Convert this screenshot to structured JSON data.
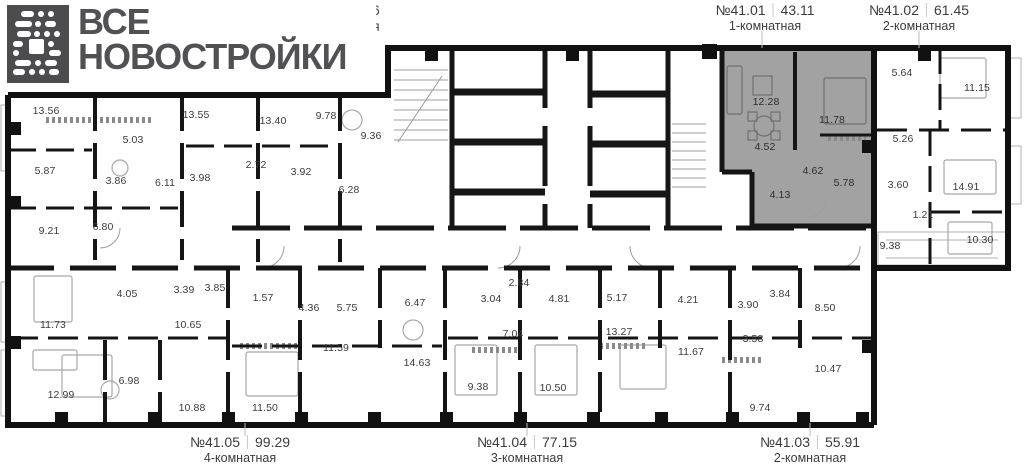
{
  "logo": {
    "line1": "ВСЕ",
    "line2": "НОВОСТРОЙКИ",
    "icon": "pixel-b-logo-icon"
  },
  "top_partial_text": {
    "line1": "46",
    "line2": "ия"
  },
  "colors": {
    "highlight_fill": "#a2a2a2",
    "wall": "#111111",
    "label_text": "#3b3b3b",
    "logo_background": "#4c4c4e",
    "logo_text": "#515154",
    "thin_line": "#9c9c9c",
    "leader_line": "#bbbbbb"
  },
  "apartment_labels": {
    "top": [
      {
        "number": "№41.01",
        "area": "43.11",
        "type": "1-комнатная",
        "x": 765,
        "highlighted": true
      },
      {
        "number": "№41.02",
        "area": "61.45",
        "type": "2-комнатная",
        "x": 919,
        "highlighted": false
      }
    ],
    "bottom": [
      {
        "number": "№41.05",
        "area": "99.29",
        "type": "4-комнатная",
        "x": 240,
        "highlighted": false
      },
      {
        "number": "№41.04",
        "area": "77.15",
        "type": "3-комнатная",
        "x": 527,
        "highlighted": false
      },
      {
        "number": "№41.03",
        "area": "55.91",
        "type": "2-комнатная",
        "x": 810,
        "highlighted": false
      }
    ]
  },
  "highlighted_apartment": {
    "number": "№41.01",
    "total_area": "43.11",
    "type": "1-комнатная",
    "room_areas": [
      "12.28",
      "11.78",
      "4.52",
      "4.62",
      "5.78",
      "4.13"
    ]
  },
  "rooms": [
    {
      "label": "13.56",
      "x": 46,
      "y": 111,
      "hl": false
    },
    {
      "label": "5.03",
      "x": 133,
      "y": 140,
      "hl": false
    },
    {
      "label": "13.55",
      "x": 196,
      "y": 115,
      "hl": false
    },
    {
      "label": "13.40",
      "x": 273,
      "y": 121,
      "hl": false
    },
    {
      "label": "9.78",
      "x": 326,
      "y": 116,
      "hl": false
    },
    {
      "label": "9.36",
      "x": 371,
      "y": 136,
      "hl": false
    },
    {
      "label": "5.87",
      "x": 45,
      "y": 171,
      "hl": false
    },
    {
      "label": "3.86",
      "x": 116,
      "y": 181,
      "hl": false
    },
    {
      "label": "6.11",
      "x": 165,
      "y": 183,
      "hl": false
    },
    {
      "label": "3.98",
      "x": 200,
      "y": 178,
      "hl": false
    },
    {
      "label": "2.72",
      "x": 256,
      "y": 165,
      "hl": false
    },
    {
      "label": "3.92",
      "x": 301,
      "y": 172,
      "hl": false
    },
    {
      "label": "6.28",
      "x": 349,
      "y": 190,
      "hl": false
    },
    {
      "label": "9.21",
      "x": 49,
      "y": 231,
      "hl": false
    },
    {
      "label": "6.80",
      "x": 103,
      "y": 227,
      "hl": false
    },
    {
      "label": "4.05",
      "x": 127,
      "y": 294,
      "hl": false
    },
    {
      "label": "3.39",
      "x": 184,
      "y": 290,
      "hl": false
    },
    {
      "label": "3.85",
      "x": 215,
      "y": 288,
      "hl": false
    },
    {
      "label": "11.73",
      "x": 53,
      "y": 325,
      "hl": false
    },
    {
      "label": "10.65",
      "x": 188,
      "y": 325,
      "hl": false
    },
    {
      "label": "12.99",
      "x": 61,
      "y": 395,
      "hl": false
    },
    {
      "label": "6.98",
      "x": 129,
      "y": 381,
      "hl": false
    },
    {
      "label": "10.88",
      "x": 192,
      "y": 408,
      "hl": false
    },
    {
      "label": "1.57",
      "x": 263,
      "y": 298,
      "hl": false
    },
    {
      "label": "4.36",
      "x": 309,
      "y": 308,
      "hl": false
    },
    {
      "label": "5.75",
      "x": 347,
      "y": 308,
      "hl": false
    },
    {
      "label": "6.47",
      "x": 415,
      "y": 303,
      "hl": false
    },
    {
      "label": "11.59",
      "x": 336,
      "y": 348,
      "hl": false
    },
    {
      "label": "14.63",
      "x": 417,
      "y": 363,
      "hl": false
    },
    {
      "label": "11.50",
      "x": 265,
      "y": 408,
      "hl": false
    },
    {
      "label": "2.84",
      "x": 519,
      "y": 283,
      "hl": false
    },
    {
      "label": "3.04",
      "x": 491,
      "y": 299,
      "hl": false
    },
    {
      "label": "4.81",
      "x": 559,
      "y": 299,
      "hl": false
    },
    {
      "label": "5.17",
      "x": 617,
      "y": 298,
      "hl": false
    },
    {
      "label": "4.21",
      "x": 688,
      "y": 300,
      "hl": false
    },
    {
      "label": "7.04",
      "x": 513,
      "y": 334,
      "hl": false
    },
    {
      "label": "13.27",
      "x": 619,
      "y": 332,
      "hl": false
    },
    {
      "label": "11.67",
      "x": 691,
      "y": 352,
      "hl": false
    },
    {
      "label": "9.38",
      "x": 478,
      "y": 387,
      "hl": false
    },
    {
      "label": "10.50",
      "x": 553,
      "y": 388,
      "hl": false
    },
    {
      "label": "3.84",
      "x": 780,
      "y": 294,
      "hl": false
    },
    {
      "label": "3.90",
      "x": 748,
      "y": 305,
      "hl": false
    },
    {
      "label": "8.50",
      "x": 825,
      "y": 308,
      "hl": false
    },
    {
      "label": "3.58",
      "x": 753,
      "y": 339,
      "hl": false
    },
    {
      "label": "10.47",
      "x": 828,
      "y": 369,
      "hl": false
    },
    {
      "label": "9.74",
      "x": 760,
      "y": 408,
      "hl": false
    },
    {
      "label": "5.64",
      "x": 902,
      "y": 73,
      "hl": false
    },
    {
      "label": "11.15",
      "x": 977,
      "y": 88,
      "hl": false
    },
    {
      "label": "5.26",
      "x": 903,
      "y": 139,
      "hl": false
    },
    {
      "label": "3.60",
      "x": 898,
      "y": 185,
      "hl": false
    },
    {
      "label": "14.91",
      "x": 966,
      "y": 187,
      "hl": false
    },
    {
      "label": "1.21",
      "x": 923,
      "y": 215,
      "hl": false
    },
    {
      "label": "9.38",
      "x": 890,
      "y": 246,
      "hl": false
    },
    {
      "label": "10.30",
      "x": 980,
      "y": 240,
      "hl": false
    },
    {
      "label": "12.28",
      "x": 766,
      "y": 102,
      "hl": true
    },
    {
      "label": "11.78",
      "x": 832,
      "y": 120,
      "hl": true
    },
    {
      "label": "4.52",
      "x": 765,
      "y": 147,
      "hl": true
    },
    {
      "label": "4.62",
      "x": 813,
      "y": 171,
      "hl": true
    },
    {
      "label": "5.78",
      "x": 844,
      "y": 183,
      "hl": true
    },
    {
      "label": "4.13",
      "x": 780,
      "y": 195,
      "hl": true
    }
  ]
}
